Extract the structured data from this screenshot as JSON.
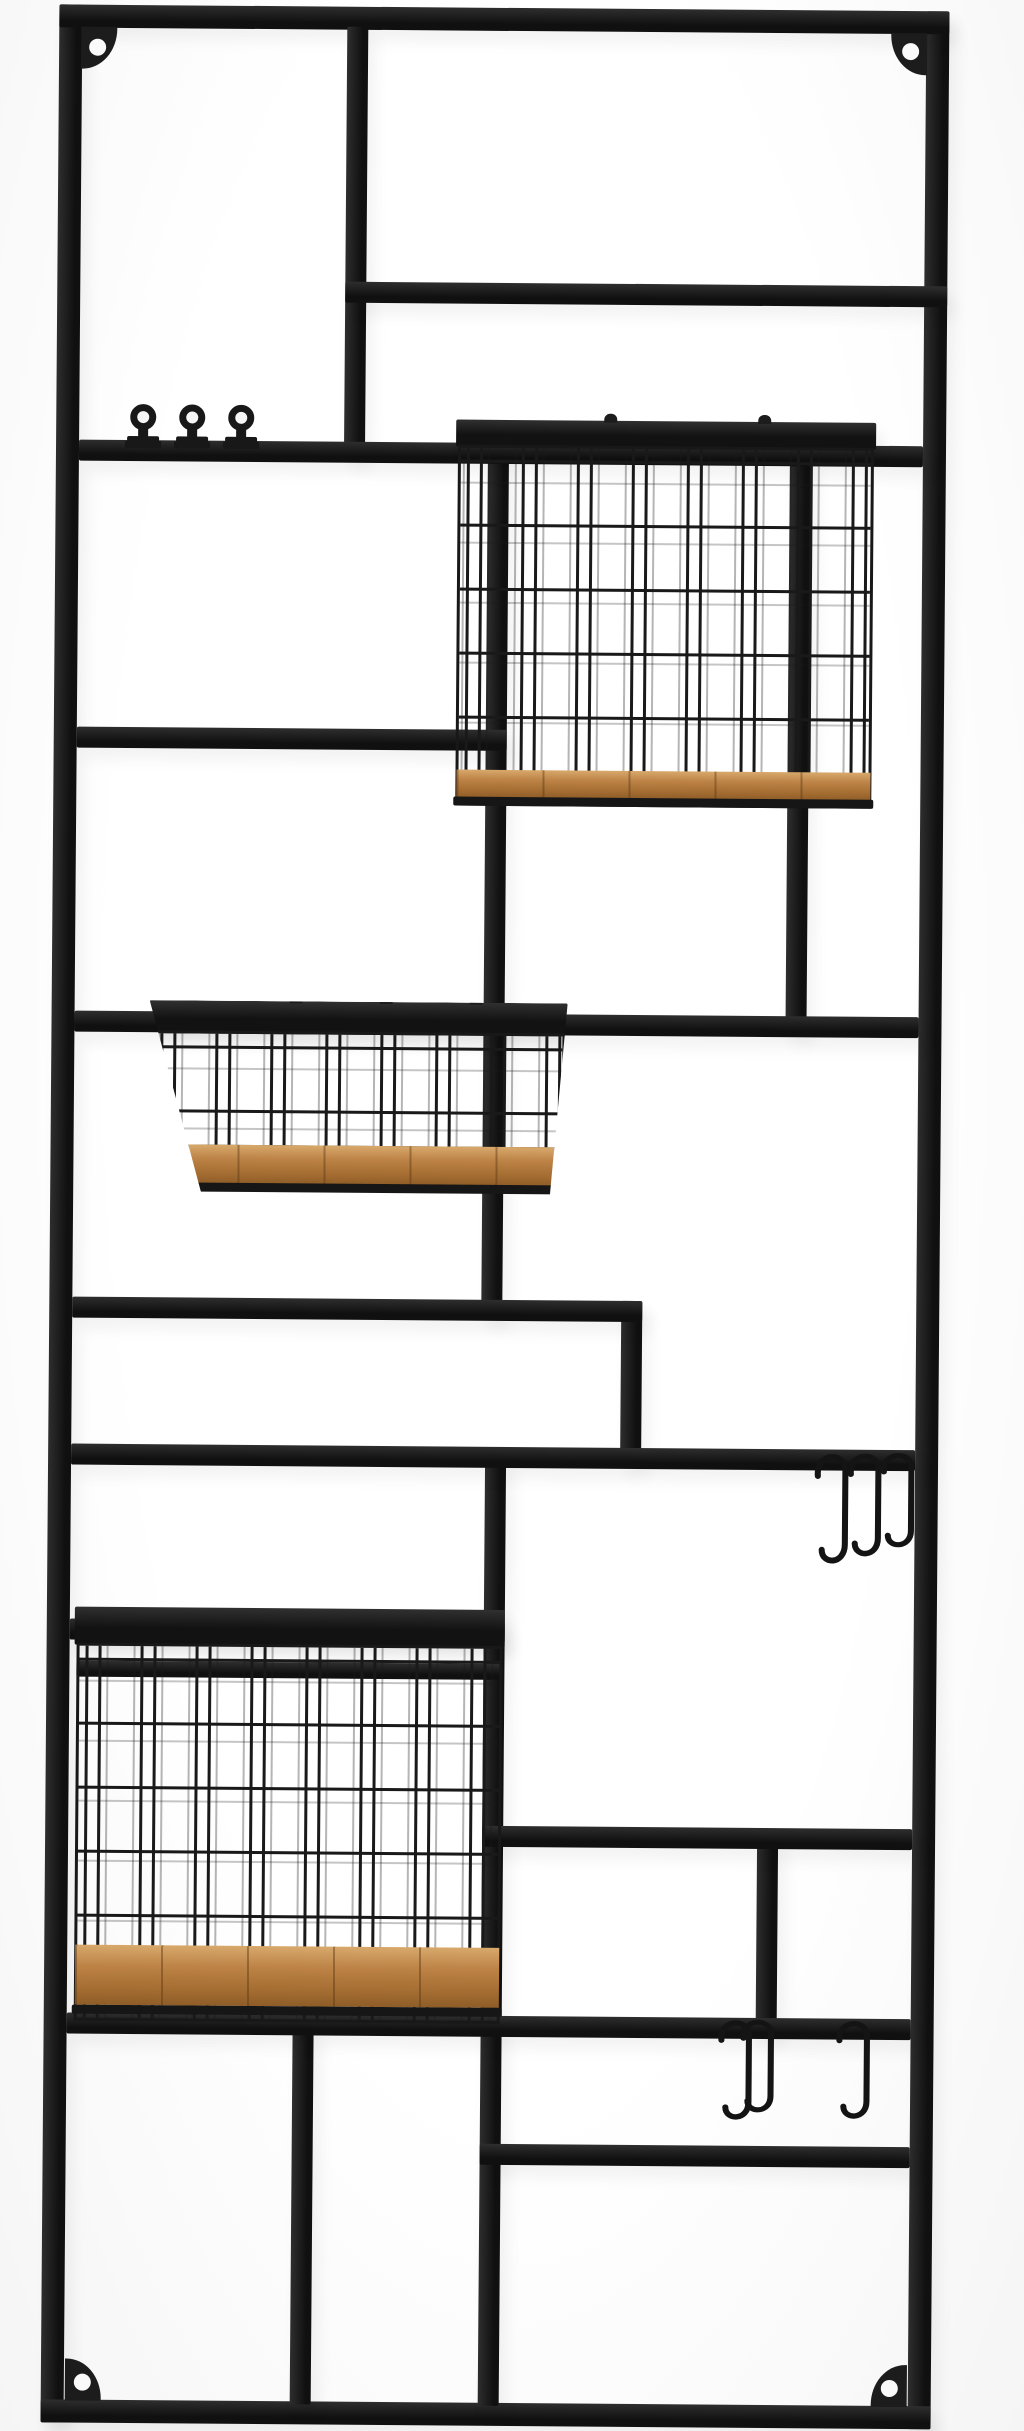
{
  "scene": {
    "description": "Tall black metal wall-mounted grid organizer rack with rectangular compartments, three wire baskets with natural wood plank bases, three round wall knobs, six black S-hooks and four corner screw mounting holes, photographed on a plain white background.",
    "orientation": "portrait",
    "background_color": "#fcfcfc",
    "metal_color": "#1c1c1c",
    "wood_color": "#bd8347"
  },
  "rack": {
    "mounting_holes": {
      "count": 4,
      "positions": [
        "top-left",
        "top-right",
        "bottom-left",
        "bottom-right"
      ]
    },
    "knobs": {
      "count": 3,
      "centers_x": [
        120,
        169,
        218
      ],
      "row_y": 407
    },
    "baskets": [
      {
        "name": "top-right wire basket",
        "wood_base": true
      },
      {
        "name": "middle-left wire basket",
        "wood_base": true
      },
      {
        "name": "bottom-left wire basket",
        "wood_base": true
      }
    ],
    "s_hook_groups": [
      {
        "name": "upper-right S-hooks",
        "count": 3
      },
      {
        "name": "lower-right S-hooks",
        "count": 3
      }
    ],
    "s_hooks": [
      {
        "x": 810,
        "y": 1440,
        "h": 130
      },
      {
        "x": 843,
        "y": 1440,
        "h": 122
      },
      {
        "x": 876,
        "y": 1440,
        "h": 112
      },
      {
        "x": 718,
        "y": 2008,
        "h": 118
      },
      {
        "x": 740,
        "y": 2008,
        "h": 110
      },
      {
        "x": 836,
        "y": 2008,
        "h": 116
      }
    ]
  }
}
